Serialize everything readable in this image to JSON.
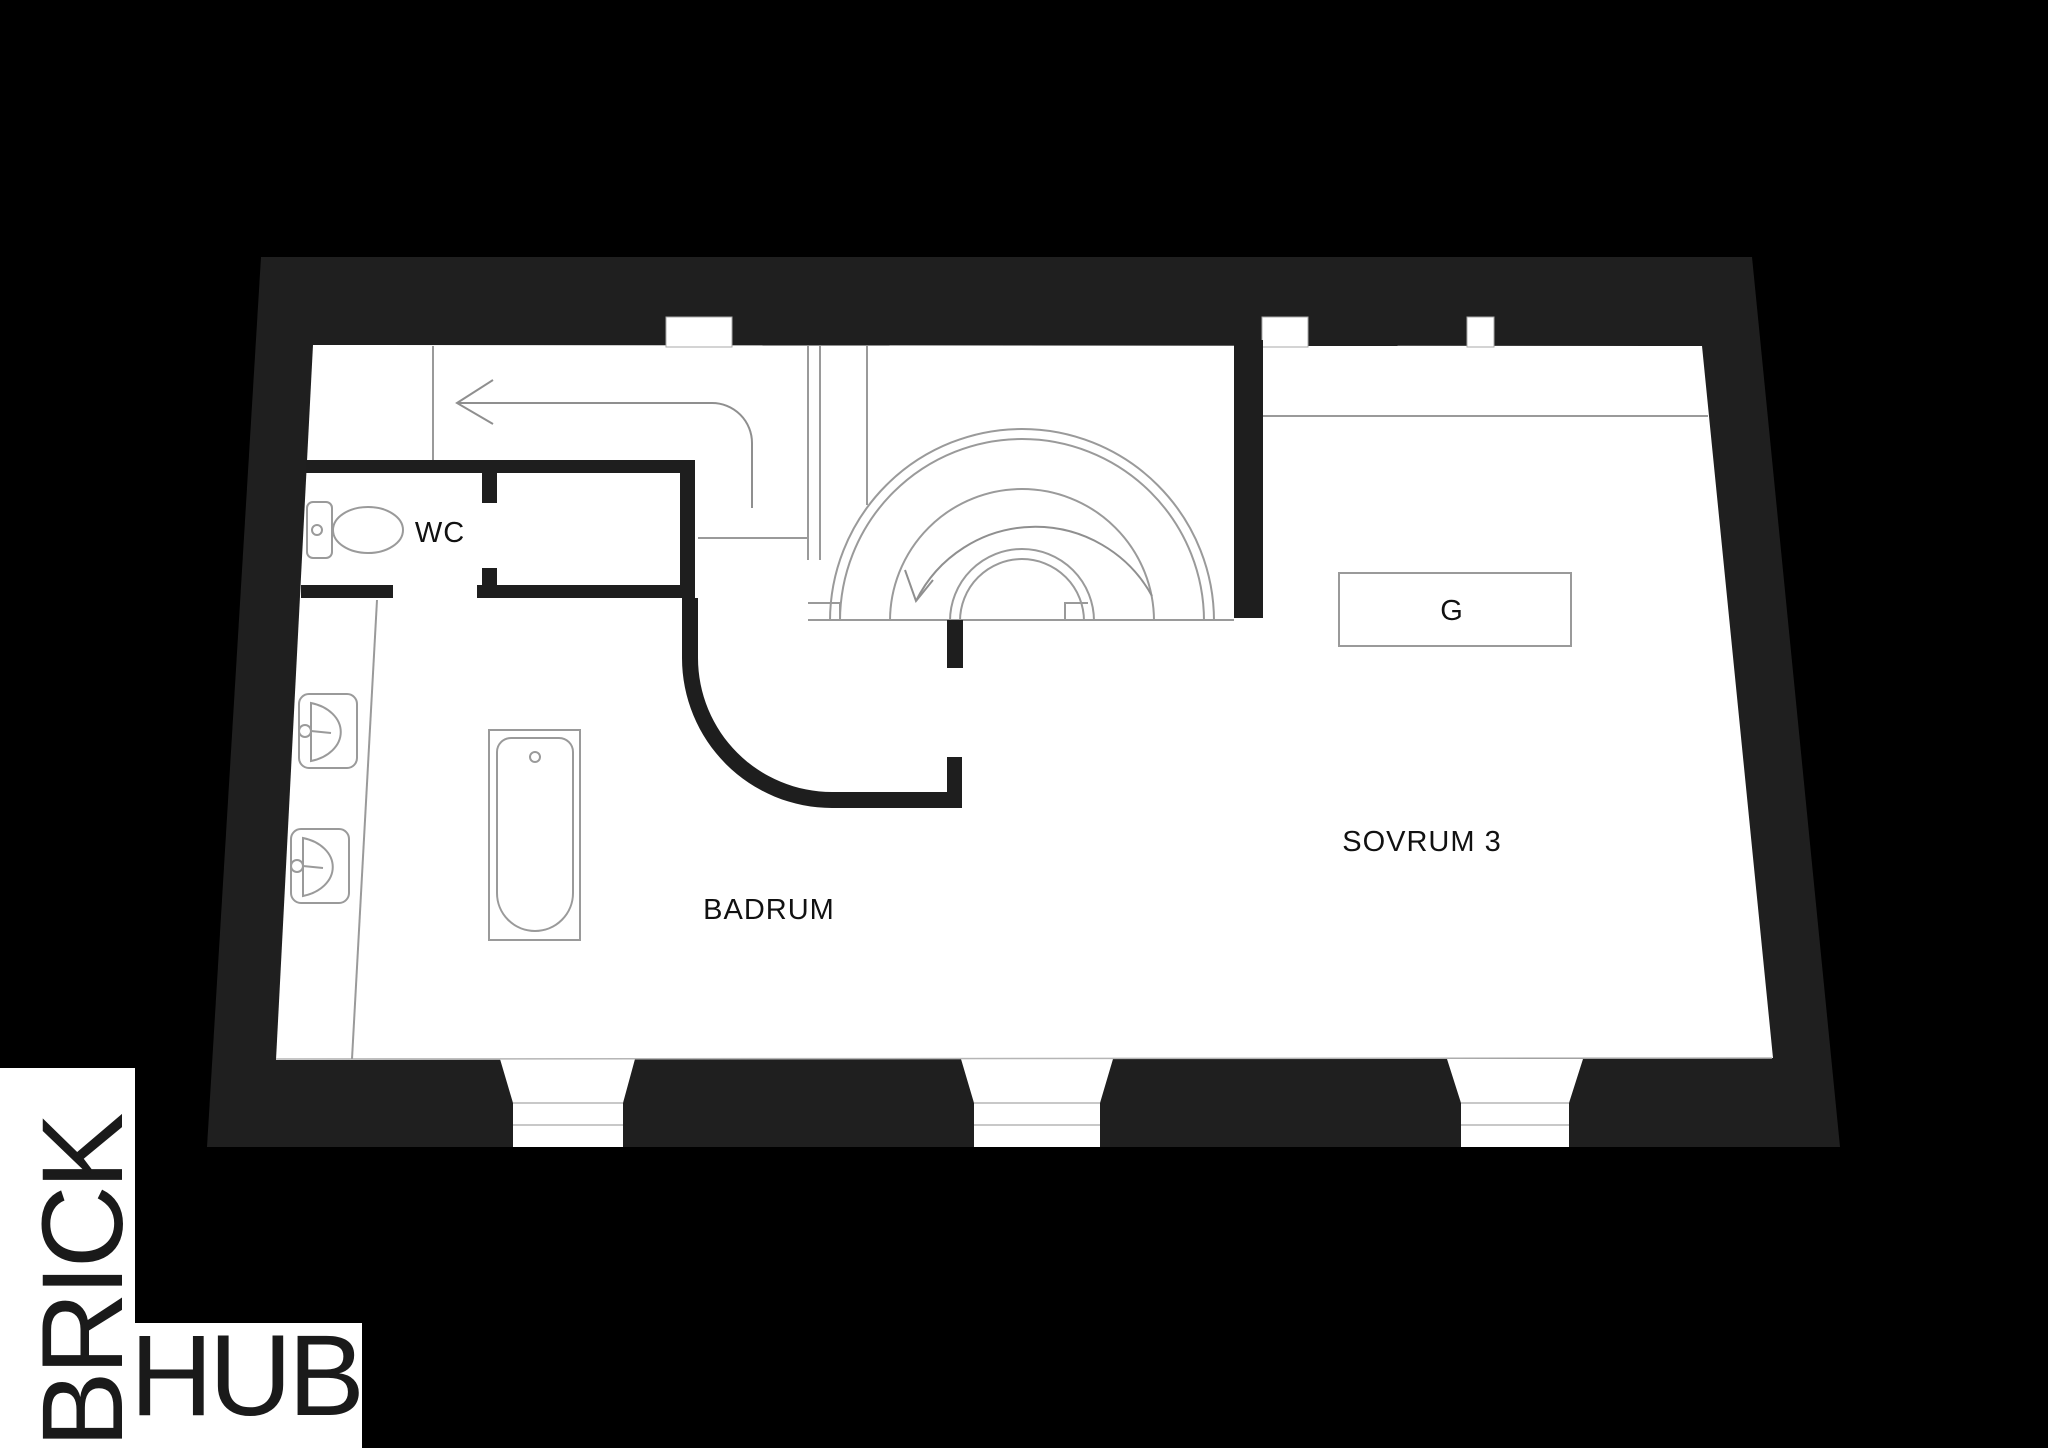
{
  "page": {
    "width": 2048,
    "height": 1448,
    "type": "floor-plan"
  },
  "colors": {
    "backdrop": "#000000",
    "wall_poche": "#1f1f1f",
    "paper": "#ffffff",
    "line": "#9a9a9a",
    "ink": "#111111",
    "watermark": "#1a1a1a"
  },
  "rooms": {
    "wc": "WC",
    "badrum": "BADRUM",
    "sovrum": "SOVRUM 3",
    "wardrobe": "G"
  },
  "watermark": {
    "word_vertical": "BRICK",
    "word_horizontal": "HUB"
  }
}
